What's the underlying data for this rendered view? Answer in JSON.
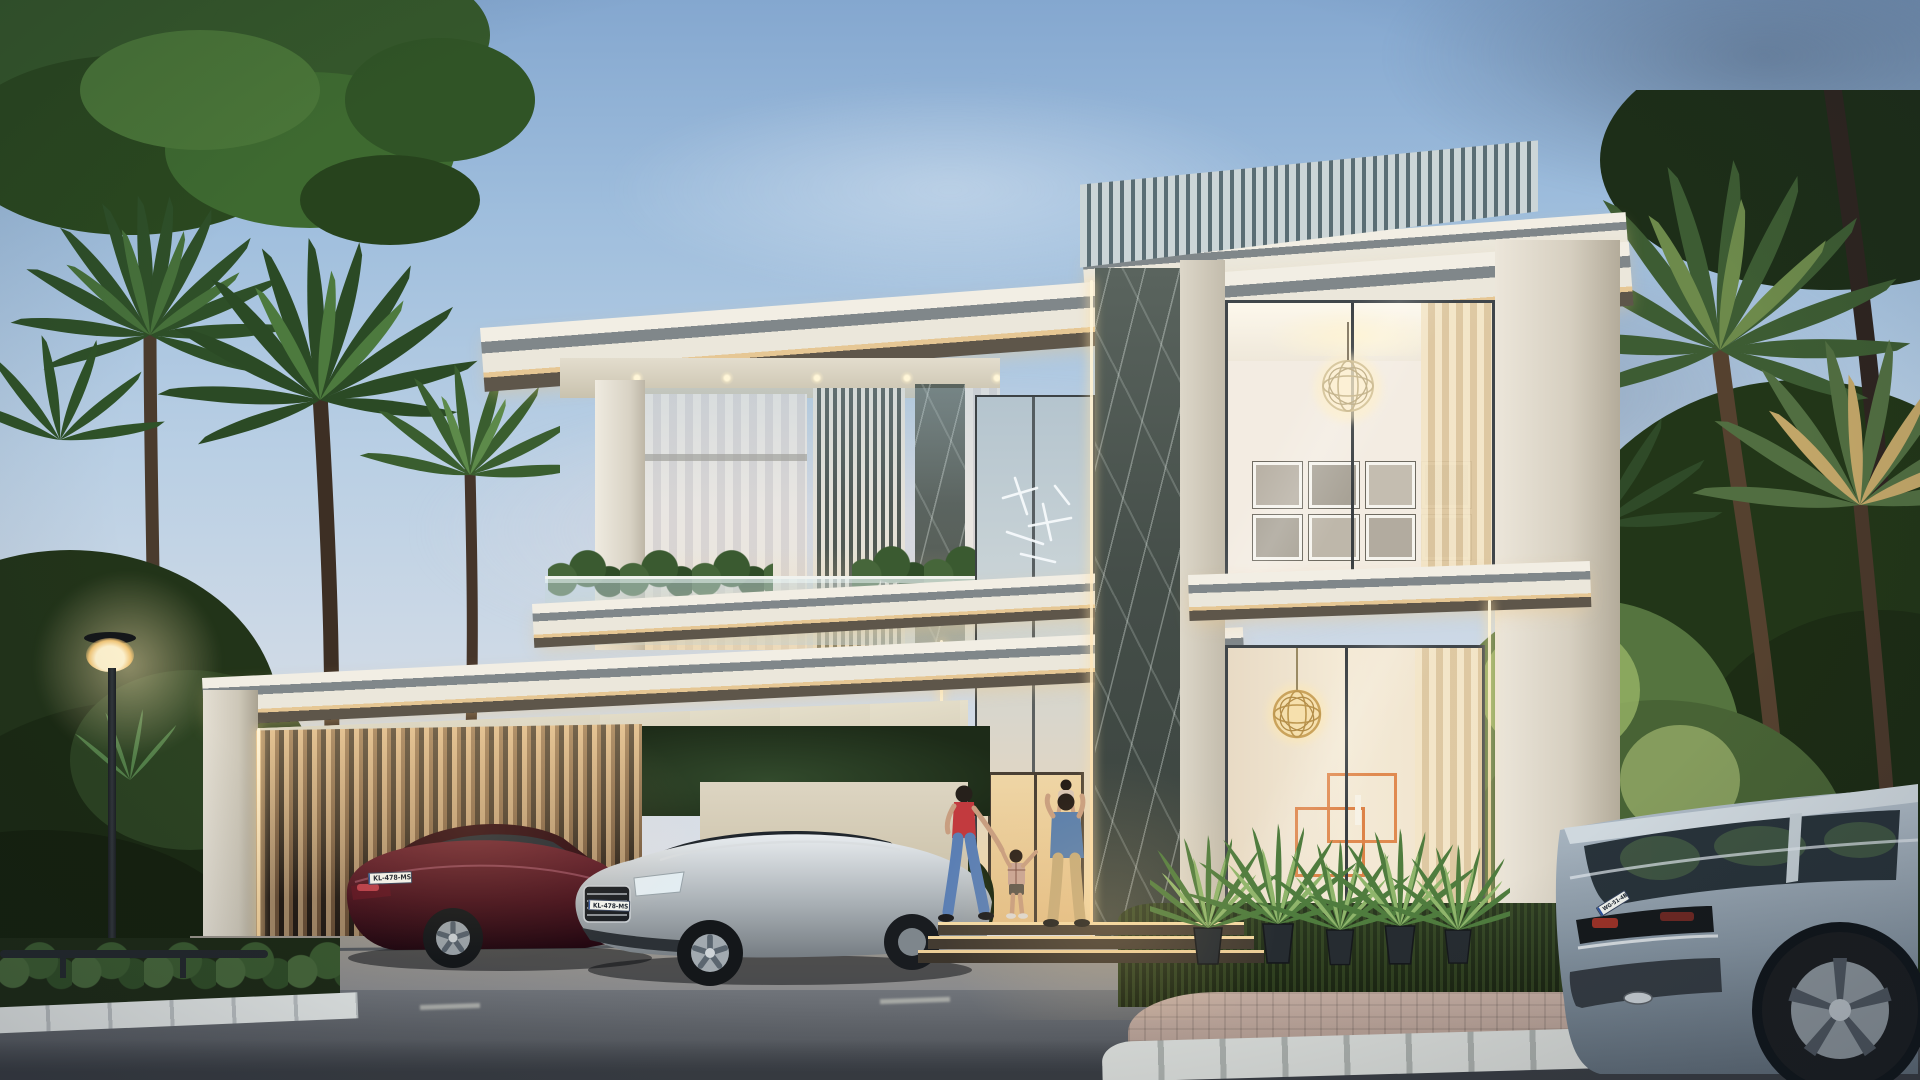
{
  "scene": {
    "title": "Modern two-storey luxury villa at dusk",
    "medium": "photorealistic 3D architectural rendering",
    "time_of_day": "dusk",
    "setting": "tropical street lined with fan palms",
    "camera": "street-level three-quarter front view"
  },
  "palette": {
    "sky_top": "#84a7cf",
    "sky_horizon": "#d9dee6",
    "cloud_slate": "#7b8fa8",
    "cloud_pink": "#e6d8da",
    "facade_white": "#ece8dd",
    "fascia_grey_band": "#7d8487",
    "led_gold": "#e8c896",
    "marble_dark": "#4b544f",
    "glass_blue": "#b9c8d2",
    "curtain_sheer": "#e9e2d8",
    "curtain_gold": "#e3cda4",
    "louver_dark": "#39423e",
    "carport_slat_warm": "#d8b488",
    "interior_warm": "#f3e9d6",
    "art_orange": "#e08a50",
    "foliage_dark": "#2b4226",
    "foliage_sunlit": "#7fa05a",
    "grass_dark": "#1f2c15",
    "asphalt": "#5d6167",
    "paver_pink": "#b9a49a",
    "curb_granite": "#cfd2cf",
    "street_lamp_glow": "#ffe9b8"
  },
  "villa": {
    "storeys": 2,
    "rooftop_slat_screen": {
      "slat_count": 40
    },
    "carport": {
      "ceiling_downlights": 8,
      "bays": 2
    },
    "gallery_wall_frames": 8,
    "front_potted_plants": 5,
    "entrance_steps": 3,
    "balcony": "glass balustrade with planter hedges",
    "features": [
      "flat roof with deep overhang",
      "vertical louvre screens",
      "dark marble clad columns",
      "warm LED strip lighting",
      "double-height glass atrium",
      "globe chandelier",
      "gold openwork pendant lamp",
      "orange geometric wall art",
      "sheer curtains"
    ]
  },
  "vehicles": {
    "maroon_sedan": {
      "type": "sedan",
      "colour": "dark maroon",
      "body_hex": "#45101c",
      "plate": "KL-478-MS",
      "view": "rear three-quarter, parked in carport"
    },
    "silver_sedan": {
      "type": "sedan",
      "colour": "silver",
      "body_hex": "#b7bdc2",
      "plate": "KL-478-MS",
      "view": "front three-quarter, parked in carport"
    },
    "grey_suv": {
      "type": "SUV",
      "colour": "grey-blue",
      "body_hex": "#93a2ae",
      "plate": "WG-51-4B",
      "view": "rear three-quarter, street foreground right"
    }
  },
  "people": [
    {
      "id": "woman",
      "description": "woman with dark hair, red top and blue jeans walking to the door"
    },
    {
      "id": "boy",
      "description": "young boy in plaid shirt and shorts held by the hand"
    },
    {
      "id": "man",
      "description": "man in blue shirt and beige trousers carrying a toddler on his shoulders"
    }
  ],
  "street": {
    "lamp": "park-style lamp post, lit",
    "kerb": "granite kerb stones",
    "sidewalk": "pink block pavers",
    "hedge_rail": "low dark rail fence in left hedge"
  }
}
